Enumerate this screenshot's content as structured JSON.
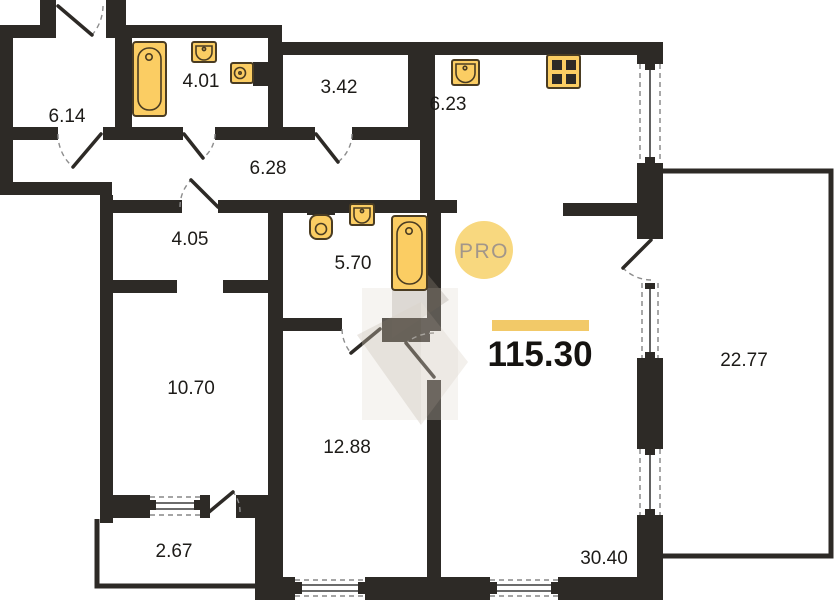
{
  "plan": {
    "badge_text": "PRO",
    "total_area": "115.30"
  },
  "rooms": [
    {
      "area": "6.14"
    },
    {
      "area": "4.01"
    },
    {
      "area": "3.42"
    },
    {
      "area": "6.23"
    },
    {
      "area": "6.28"
    },
    {
      "area": "4.05"
    },
    {
      "area": "5.70"
    },
    {
      "area": "10.70"
    },
    {
      "area": "12.88"
    },
    {
      "area": "2.67"
    },
    {
      "area": "30.40"
    },
    {
      "area": "22.77"
    }
  ],
  "icons": {
    "fixtures": [
      "bathtub-icon",
      "sink-icon",
      "toilet-icon",
      "stove-icon"
    ],
    "symbols": [
      "door-swing-symbol",
      "window-symbol"
    ]
  },
  "colors": {
    "wall": "#2d2a26",
    "fixtureFill": "#fbcd63",
    "fixtureStroke": "#4a3c22",
    "accentBar": "#f2c968",
    "badgeBg": "#f8d87f",
    "badgeText": "#a2968a",
    "label": "#1d1b18"
  }
}
